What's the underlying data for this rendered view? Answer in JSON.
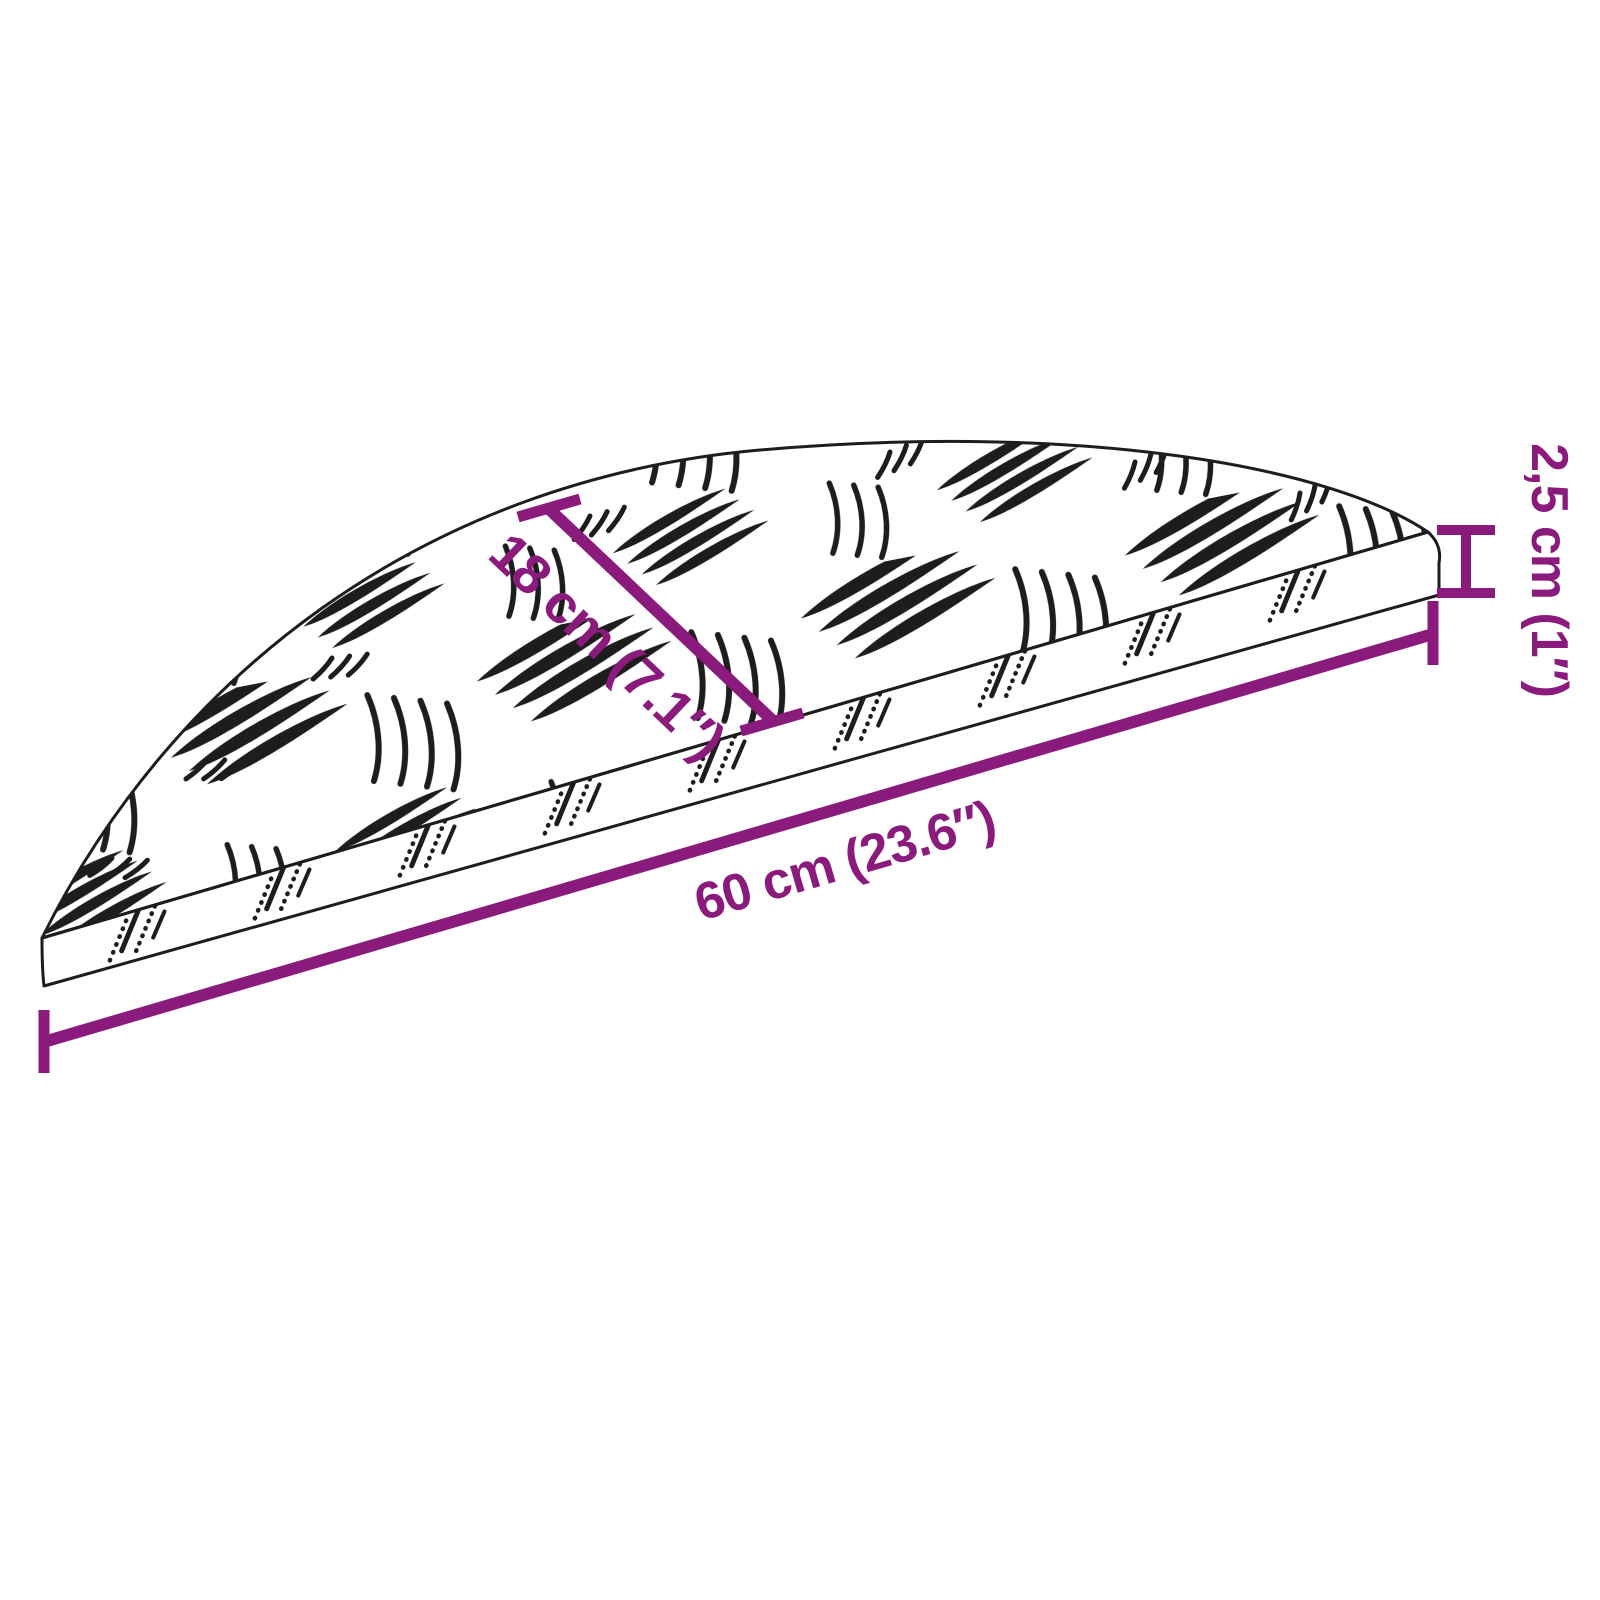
{
  "diagram": {
    "figure": "stair-tread-plate-dimension-drawing",
    "labels": {
      "depth": "18 cm (7.1″)",
      "width": "60 cm (23.6″)",
      "height": "2,5 cm (1″)"
    },
    "colors": {
      "dimension_annotation": "#8b1a7d",
      "line_art": "#1d1d1d",
      "background": "#ffffff"
    }
  }
}
